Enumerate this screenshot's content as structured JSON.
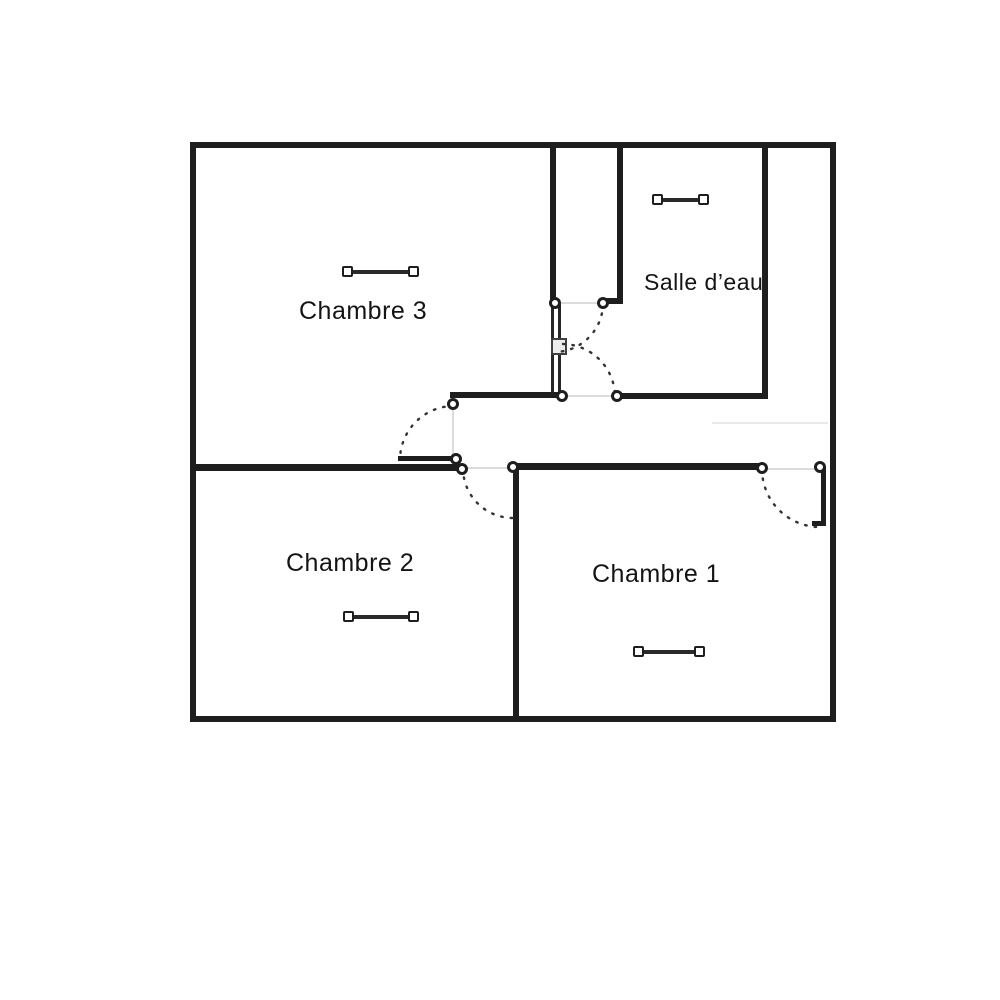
{
  "plan": {
    "type": "floor-plan",
    "rooms": [
      {
        "id": "chambre-3",
        "label": "Chambre 3"
      },
      {
        "id": "salle-d-eau",
        "label": "Salle d’eau"
      },
      {
        "id": "chambre-2",
        "label": "Chambre 2"
      },
      {
        "id": "chambre-1",
        "label": "Chambre 1"
      }
    ],
    "elements": {
      "door_swings": [
        "chambre-3",
        "chambre-2",
        "chambre-1",
        "salle-d-eau",
        "closet"
      ],
      "window_symbols": [
        "chambre-3",
        "salle-d-eau",
        "chambre-2",
        "chambre-1"
      ]
    },
    "colors": {
      "wall": "#1e1e1e",
      "background": "#ffffff",
      "door_arc": "#333333",
      "faint_line": "#dcdcdc"
    }
  }
}
